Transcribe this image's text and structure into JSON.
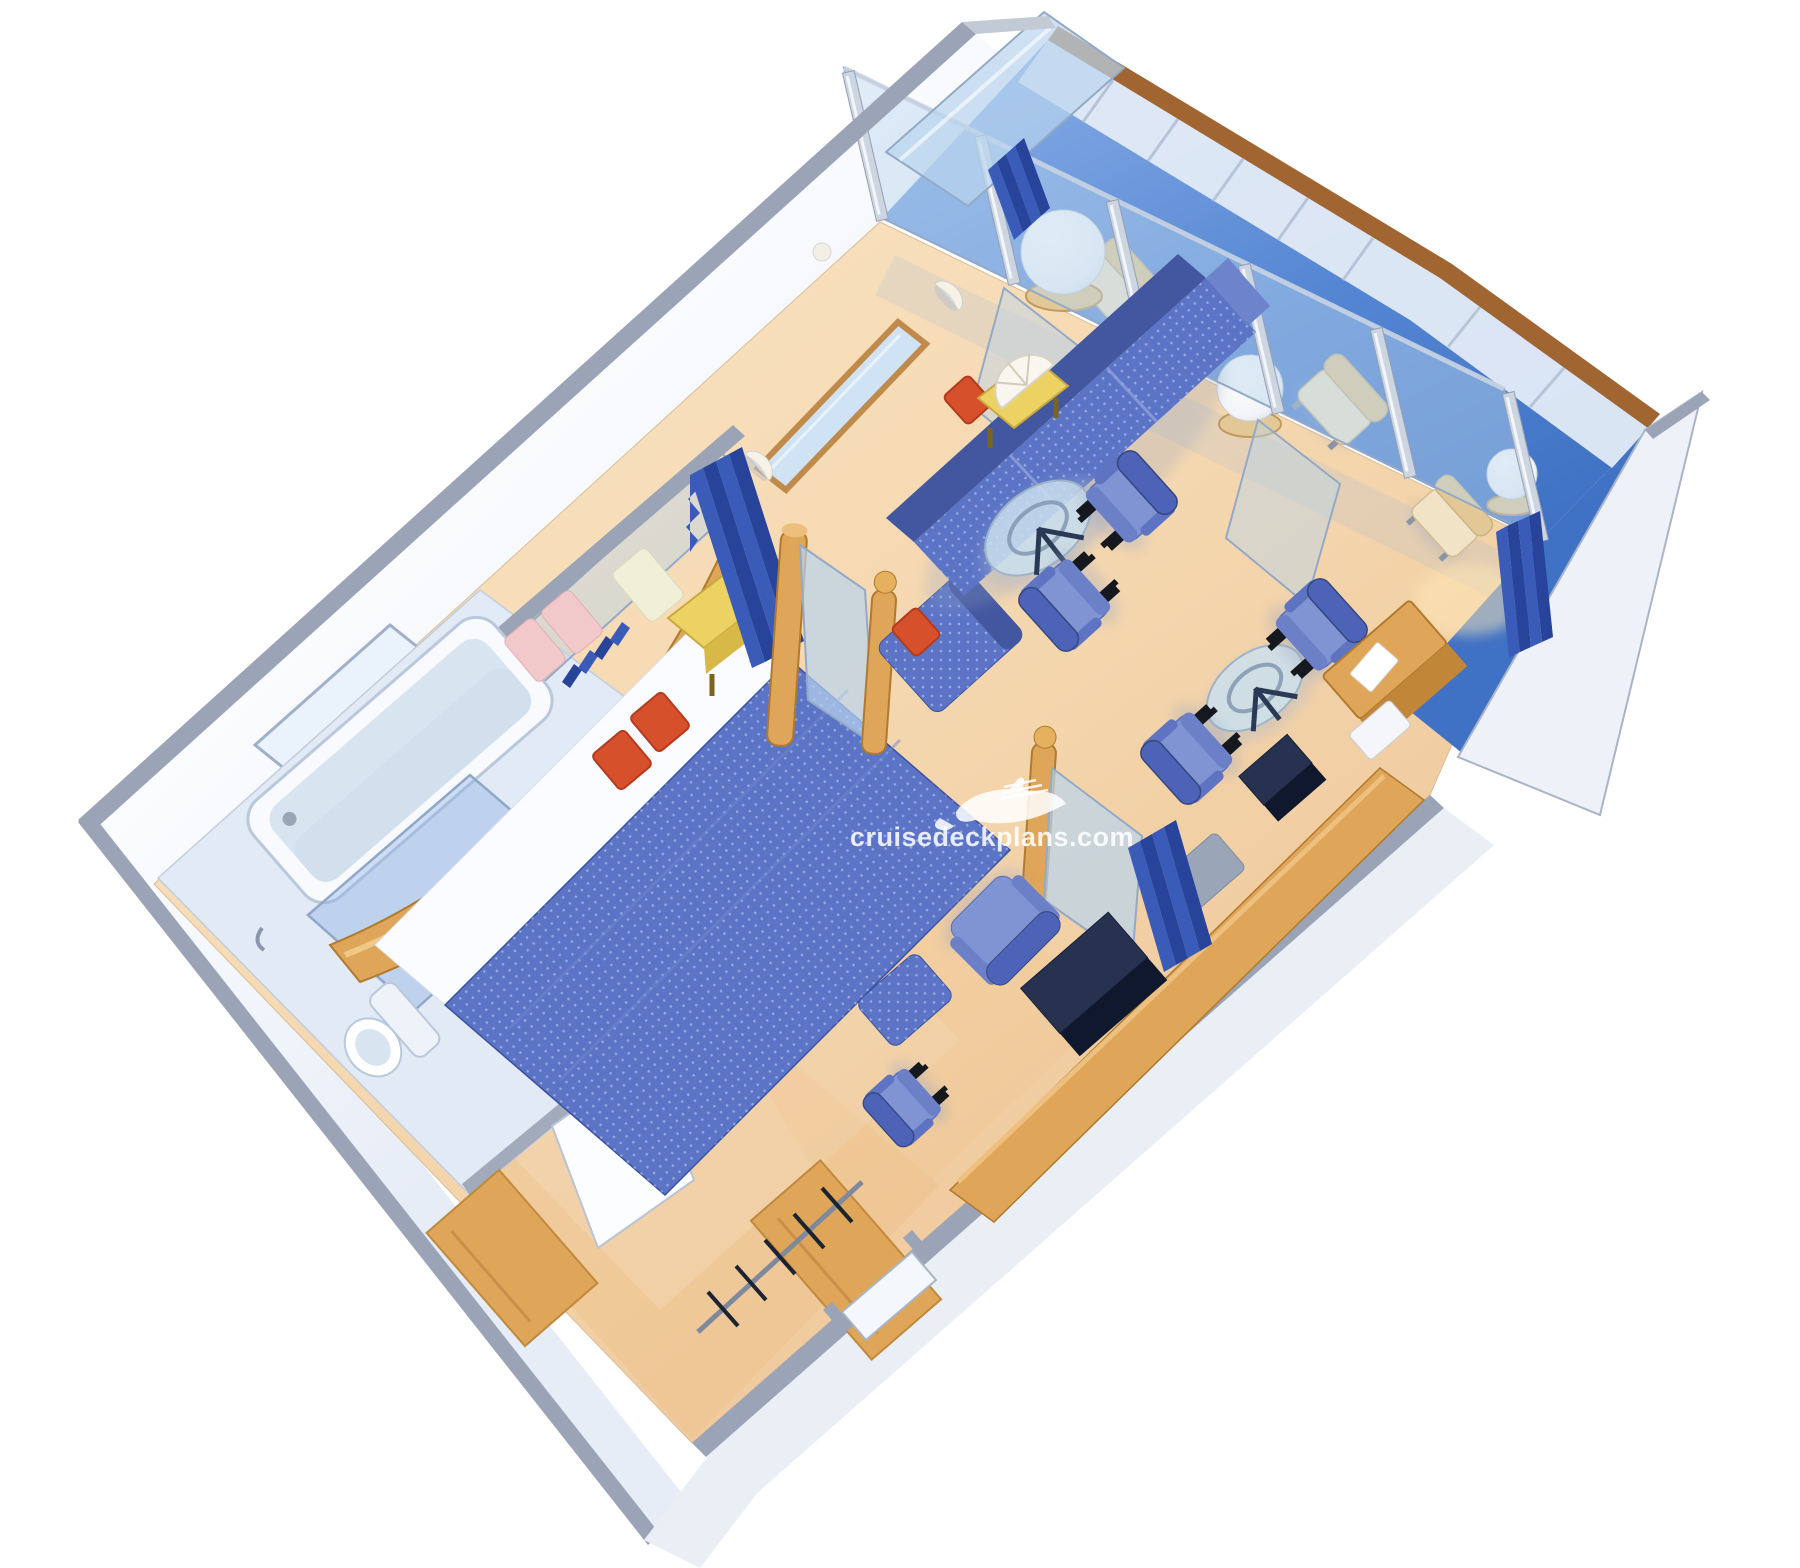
{
  "watermark": {
    "text": "cruisedeckplans.com",
    "icon": "cruise-ship-icon"
  },
  "colors": {
    "page_bg": "#ffffff",
    "floor_warm": "#eec28c",
    "wall_edge": "#9aa4b6",
    "bath_floor": "#e1eaf5",
    "fixture_white": "#f8fafd",
    "fixture_shade": "#d9e4f1",
    "glass_blue": "#b9d4ee",
    "glass_frame": "#93a9c6",
    "upholstery_blue": "#5b74c6",
    "upholstery_dark": "#42579f",
    "chair_seat": "#8093d2",
    "chair_back": "#4c63b8",
    "cushion_red": "#d6502c",
    "wood": "#dfa558",
    "wood_dark": "#c28638",
    "wood_rail": "#a06530",
    "table_yellow": "#ecd263",
    "curtain_blue": "#3a5cb8",
    "curtain_dark": "#27439a",
    "lamp_white": "#f8f6ef",
    "tan_seat": "#f0e3c6",
    "tan_back": "#e2c896",
    "cabinet_dark": "#273250",
    "watermark_white": "#ffffff"
  },
  "scene": {
    "type": "isometric-cutaway-floor-plan",
    "subject": "cruise ship grand suite stateroom with private balcony",
    "rooms": [
      {
        "name": "bathroom",
        "items": [
          "bathtub",
          "frosted-window",
          "vanity-twin-sinks",
          "toilet",
          "shower-glass-panel"
        ]
      },
      {
        "name": "bedroom",
        "items": [
          "double-bed",
          "curved-wood-headboard",
          "pink-pillows",
          "red-cushions",
          "yellow-nightstand",
          "privacy-curtain",
          "wood-posts",
          "mirror-divider",
          "sofa-chaise"
        ]
      },
      {
        "name": "living-room",
        "items": [
          "sofa",
          "side-table-with-fan-lamp",
          "glass-coffee-table",
          "armchairs",
          "writing-desk",
          "tv-cabinet",
          "bar-counter",
          "recliner-chair",
          "ottoman",
          "side-chair",
          "divider-curtain"
        ]
      },
      {
        "name": "entry",
        "items": [
          "wardrobe-closet",
          "clothes-rail-with-hangers",
          "entry-door",
          "open-bathroom-door"
        ]
      },
      {
        "name": "balcony",
        "items": [
          "blue-deck",
          "glass-partition-doors",
          "lounge-chairs",
          "round-side-tables",
          "globe-lamps",
          "glass-balustrade",
          "wood-cap-rail",
          "privacy-divider-panel",
          "balcony-curtains"
        ]
      }
    ]
  }
}
